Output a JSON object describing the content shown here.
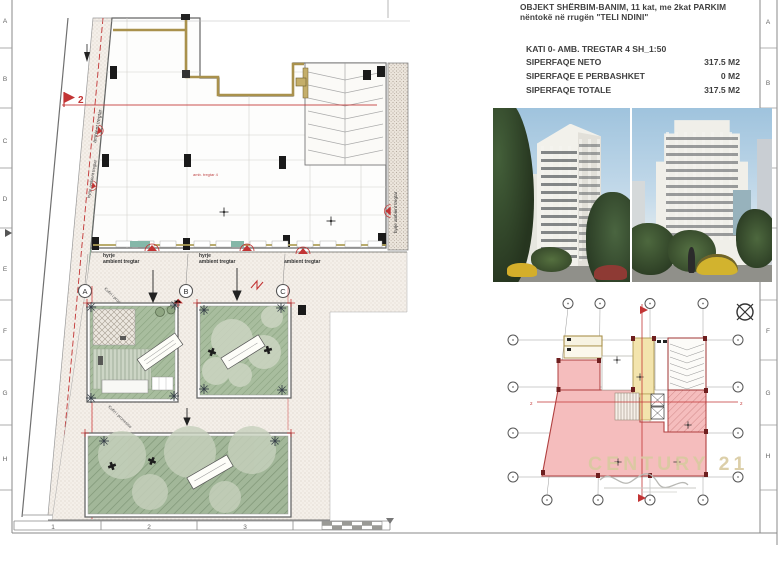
{
  "title_block": {
    "line1": "OBJEKT SHËRBIM-BANIM, 11 kat, me  2kat PARKIM",
    "line2": "nëntokë në rrugën \"TELI NDINI\"",
    "subtitle": "KATI 0- AMB. TREGTAR 4  SH_1:50",
    "rows": [
      {
        "label": "SIPERFAQE NETO",
        "value": "317.5 M2"
      },
      {
        "label": "SIPERFAQE E PERBASHKET",
        "value": "0 M2"
      },
      {
        "label": "SIPERFAQE TOTALE",
        "value": "317.5 M2"
      }
    ]
  },
  "rulers": {
    "left": [
      "A",
      "B",
      "C",
      "D",
      "E",
      "F",
      "G",
      "H"
    ],
    "right": [
      "A",
      "B",
      "C",
      "D",
      "E",
      "F",
      "G",
      "H"
    ],
    "bottom": [
      "1",
      "2",
      "3"
    ]
  },
  "main_plan": {
    "bubbles": [
      "A",
      "B",
      "C"
    ],
    "section_flag": "2",
    "entry_label_line1": "hyrje",
    "entry_label_line2": "ambient tregtar",
    "strip_label": "ambient tregtar",
    "strip_entry_label": "hyrje ambient tregtar",
    "right_entry_label": "hyrje ambient tregtar",
    "boundary_label": "Kufiri i pronesise",
    "area_note": "amb. tregtar 4"
  },
  "key_plan": {
    "section_h": "2",
    "watermark": "CENTURY 21"
  },
  "colors": {
    "accent_red": "#c23434",
    "tan_wall": "#a9914c",
    "courtyard_green": "#a8bd9e",
    "pink_fill": "#f5bdbd",
    "watermark_gold": "#d9caa0"
  }
}
